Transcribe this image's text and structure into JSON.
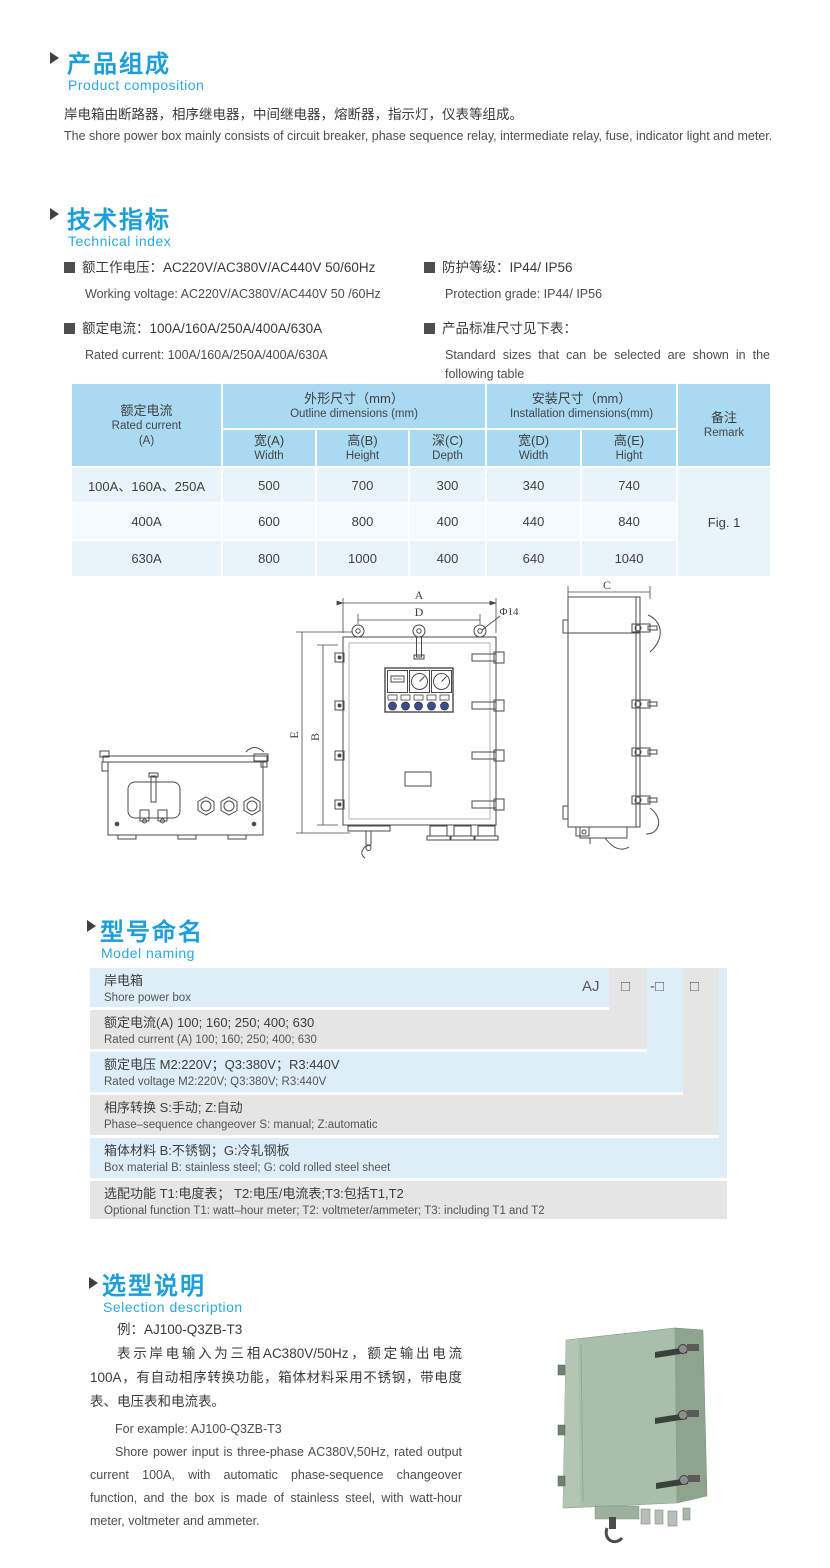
{
  "colors": {
    "accent_blue": "#1b9ed9",
    "subtitle_blue": "#2aa9e0",
    "table_header": "#a9daf1",
    "model_row_blue": "#ddeef9",
    "model_row_gray": "#e5e5e5",
    "table_row_light": "#e9f4fa",
    "product_green": "#a9bfab"
  },
  "composition": {
    "title_cn": "产品组成",
    "title_en": "Product  composition",
    "body_cn": "岸电箱由断路器，相序继电器，中间继电器，熔断器，指示灯，仪表等组成。",
    "body_en": "The shore power box mainly consists of circuit breaker, phase sequence relay, intermediate relay, fuse, indicator light and meter."
  },
  "technical": {
    "title_cn": "技术指标",
    "title_en": "Technical index",
    "specs": [
      {
        "cn": "额工作电压：AC220V/AC380V/AC440V  50/60Hz",
        "en": "Working voltage: AC220V/AC380V/AC440V 50 /60Hz"
      },
      {
        "cn": "额定电流：100A/160A/250A/400A/630A",
        "en": "Rated current: 100A/160A/250A/400A/630A"
      },
      {
        "cn": "防护等级：IP44/ IP56",
        "en": "Protection grade: IP44/ IP56"
      },
      {
        "cn": "产品标准尺寸见下表：",
        "en": "Standard sizes that can be selected are shown in the following table"
      }
    ]
  },
  "size_table": {
    "header": {
      "rated_current": {
        "cn": "额定电流",
        "en": "Rated current",
        "unit": "(A)"
      },
      "outline": {
        "cn": "外形尺寸（mm）",
        "en": "Outline dimensions (mm)"
      },
      "installation": {
        "cn": "安装尺寸（mm）",
        "en": "Installation dimensions(mm)"
      },
      "remark": {
        "cn": "备注",
        "en": "Remark"
      },
      "cols": [
        {
          "cn": "宽(A)",
          "en": "Width"
        },
        {
          "cn": "高(B)",
          "en": "Height"
        },
        {
          "cn": "深(C)",
          "en": "Depth"
        },
        {
          "cn": "宽(D)",
          "en": "Width"
        },
        {
          "cn": "高(E)",
          "en": "Hight"
        }
      ]
    },
    "rows": [
      {
        "current": "100A、160A、250A",
        "values": [
          "500",
          "700",
          "300",
          "340",
          "740"
        ]
      },
      {
        "current": "400A",
        "values": [
          "600",
          "800",
          "400",
          "440",
          "840"
        ]
      },
      {
        "current": "630A",
        "values": [
          "800",
          "1000",
          "400",
          "640",
          "1040"
        ]
      }
    ],
    "remark_value": "Fig. 1"
  },
  "drawing": {
    "dim_a": "A",
    "dim_b": "B",
    "dim_c": "C",
    "dim_d": "D",
    "dim_e": "E",
    "hole": "Φ14"
  },
  "model": {
    "title_cn": "型号命名",
    "title_en": "Model naming",
    "code": {
      "prefix": "AJ",
      "slot1": "□",
      "slot2": "-□",
      "slot3": "□"
    },
    "rows": [
      {
        "cn": "岸电箱",
        "en": "Shore power box"
      },
      {
        "cn": "额定电流(A)  100; 160; 250; 400; 630",
        "en": "Rated current (A) 100; 160; 250; 400; 630"
      },
      {
        "cn": "额定电压   M2:220V；Q3:380V；R3:440V",
        "en": "Rated voltage   M2:220V;  Q3:380V;  R3:440V"
      },
      {
        "cn": "相序转换  S:手动; Z:自动",
        "en": "Phase–sequence changeover  S: manual;  Z:automatic"
      },
      {
        "cn": "箱体材料     B:不锈钢；G:冷轧钢板",
        "en": "Box material    B: stainless steel; G: cold rolled steel sheet"
      },
      {
        "cn": "选配功能       T1:电度表； T2:电压/电流表;T3:包括T1,T2",
        "en": "Optional function   T1: watt–hour meter; T2: voltmeter/ammeter; T3: including T1 and T2"
      }
    ]
  },
  "selection": {
    "title_cn": "选型说明",
    "title_en": "Selection description",
    "example_cn": "例：AJ100-Q3ZB-T3",
    "body_cn": "表示岸电输入为三相AC380V/50Hz，额定输出电流100A，有自动相序转换功能，箱体材料采用不锈钢，带电度表、电压表和电流表。",
    "example_en": "For example: AJ100-Q3ZB-T3",
    "body_en": "Shore power input is three-phase AC380V,50Hz, rated output current 100A, with automatic phase-sequence changeover function, and the box is made of stainless steel, with watt-hour meter, voltmeter and ammeter."
  }
}
